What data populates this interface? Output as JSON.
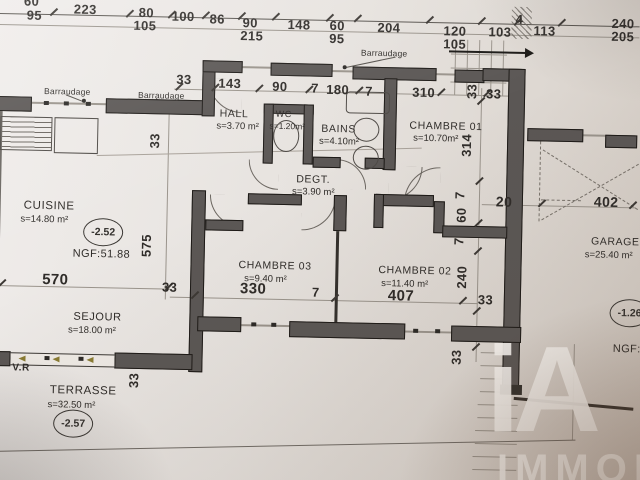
{
  "rooms": [
    {
      "name": "CUISINE",
      "area": "s=14.80 m²"
    },
    {
      "name": "HALL",
      "area": "s=3.70 m²"
    },
    {
      "name": "WC",
      "area": "s=1.20m²"
    },
    {
      "name": "BAINS",
      "area": "s=4.10m²"
    },
    {
      "name": "CHAMBRE 01",
      "area": "s=10.70m²"
    },
    {
      "name": "DEGT.",
      "area": "s=3.90 m²"
    },
    {
      "name": "CHAMBRE 03",
      "area": "s=9.40 m²"
    },
    {
      "name": "CHAMBRE 02",
      "area": "s=11.40 m²"
    },
    {
      "name": "SEJOUR",
      "area": "s=18.00 m²"
    },
    {
      "name": "TERRASSE",
      "area": "s=32.50 m²"
    },
    {
      "name": "GARAGE",
      "area": "s=25.40 m²"
    }
  ],
  "dims": [
    "60",
    "95",
    "223",
    "80",
    "105",
    "100",
    "86",
    "90",
    "215",
    "148",
    "60",
    "95",
    "204",
    "120",
    "105",
    "103",
    "4",
    "113",
    "240",
    "205",
    "33",
    "143",
    "90",
    "7",
    "180",
    "7",
    "310",
    "33",
    "33",
    "33",
    "575",
    "570",
    "33",
    "33",
    "314",
    "7",
    "60",
    "7",
    "240",
    "33",
    "33",
    "330",
    "7",
    "407",
    "20",
    "402"
  ],
  "levels": {
    "l1": "-2.52",
    "l1_ngf": "NGF:51.88",
    "l2": "-2.57",
    "l3": "-1.26",
    "l3_ngf": "NGF:53"
  },
  "labels": {
    "barraudage1": "Barraudage",
    "barraudage2": "Barraudage",
    "barraudage3": "Barraudage",
    "vr": "V.R"
  },
  "watermark": {
    "logo": "iA",
    "text": "IMMOB"
  },
  "colors": {
    "paper": "#e7e3df",
    "wall": "#5b5755",
    "ink": "#2f2c29",
    "bay_arrow": "#8a7c33",
    "watermark": "#f8f5f1"
  }
}
